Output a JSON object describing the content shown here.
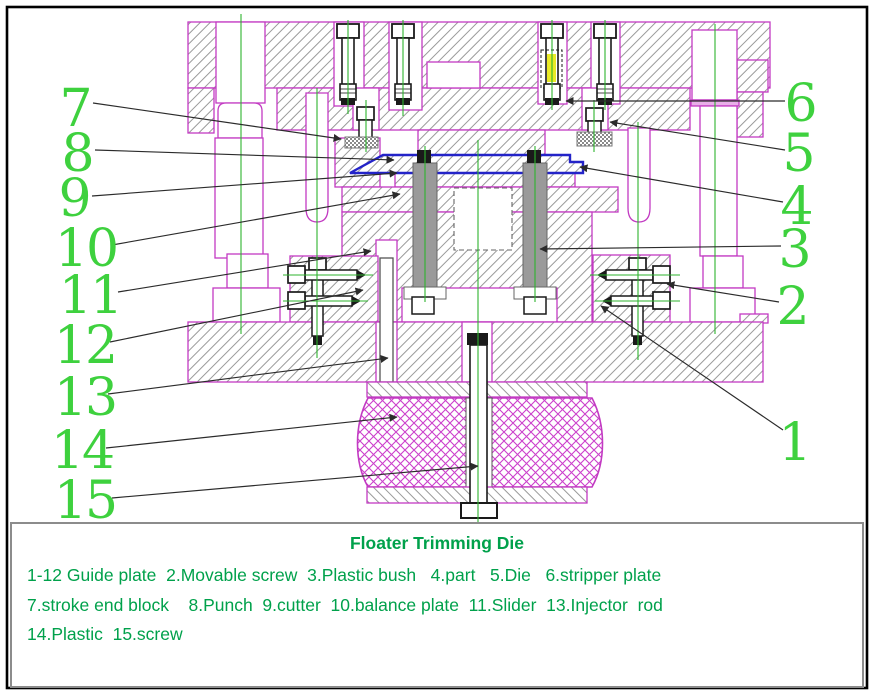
{
  "diagram": {
    "title": "Floater Trimming Die",
    "legend_lines": [
      "1-12 Guide plate  2.Movable screw  3.Plastic bush   4.part   5.Die   6.stripper plate",
      "7.stroke end block    8.Punch  9.cutter  10.balance plate  11.Slider  13.Injector  rod",
      "14.Plastic  15.screw"
    ],
    "parts": [
      {
        "no": "1-12",
        "name": "Guide plate"
      },
      {
        "no": "2",
        "name": "Movable screw"
      },
      {
        "no": "3",
        "name": "Plastic bush"
      },
      {
        "no": "4",
        "name": "part"
      },
      {
        "no": "5",
        "name": "Die"
      },
      {
        "no": "6",
        "name": "stripper plate"
      },
      {
        "no": "7",
        "name": "stroke end block"
      },
      {
        "no": "8",
        "name": "Punch"
      },
      {
        "no": "9",
        "name": "cutter"
      },
      {
        "no": "10",
        "name": "balance plate"
      },
      {
        "no": "11",
        "name": "Slider"
      },
      {
        "no": "13",
        "name": "Injector rod"
      },
      {
        "no": "14",
        "name": "Plastic"
      },
      {
        "no": "15",
        "name": "screw"
      }
    ],
    "callouts": [
      {
        "n": "7",
        "part": "stroke end block",
        "tx": 75,
        "ty": 126,
        "leader": {
          "x1": 93,
          "y1": 103,
          "x2": 341,
          "y2": 139
        }
      },
      {
        "n": "8",
        "part": "Punch",
        "tx": 77,
        "ty": 171,
        "leader": {
          "x1": 95,
          "y1": 150,
          "x2": 394,
          "y2": 160
        }
      },
      {
        "n": "9",
        "part": "cutter",
        "tx": 74,
        "ty": 216,
        "leader": {
          "x1": 92,
          "y1": 196,
          "x2": 397,
          "y2": 173
        }
      },
      {
        "n": "10",
        "part": "balance plate",
        "tx": 86,
        "ty": 266,
        "leader": {
          "x1": 112,
          "y1": 245,
          "x2": 400,
          "y2": 194
        }
      },
      {
        "n": "11",
        "part": "Slider",
        "tx": 90,
        "ty": 313,
        "leader": {
          "x1": 118,
          "y1": 292,
          "x2": 371,
          "y2": 251
        }
      },
      {
        "n": "12",
        "part": "Guide plate",
        "tx": 85,
        "ty": 363,
        "leader": {
          "x1": 110,
          "y1": 342,
          "x2": 363,
          "y2": 290
        }
      },
      {
        "n": "13",
        "part": "Injector rod",
        "tx": 85,
        "ty": 415,
        "leader": {
          "x1": 108,
          "y1": 394,
          "x2": 388,
          "y2": 358
        }
      },
      {
        "n": "14",
        "part": "Plastic",
        "tx": 82,
        "ty": 468,
        "leader": {
          "x1": 106,
          "y1": 448,
          "x2": 397,
          "y2": 417
        }
      },
      {
        "n": "15",
        "part": "screw",
        "tx": 85,
        "ty": 518,
        "leader": {
          "x1": 112,
          "y1": 498,
          "x2": 478,
          "y2": 466
        }
      },
      {
        "n": "6",
        "part": "stripper plate",
        "tx": 800,
        "ty": 121,
        "leader": {
          "x1": 785,
          "y1": 101,
          "x2": 566,
          "y2": 101
        }
      },
      {
        "n": "5",
        "part": "Die",
        "tx": 798,
        "ty": 171,
        "leader": {
          "x1": 785,
          "y1": 150,
          "x2": 610,
          "y2": 122
        }
      },
      {
        "n": "4",
        "part": "part",
        "tx": 796,
        "ty": 224,
        "leader": {
          "x1": 783,
          "y1": 202,
          "x2": 580,
          "y2": 167
        }
      },
      {
        "n": "3",
        "part": "Plastic bush",
        "tx": 794,
        "ty": 267,
        "leader": {
          "x1": 781,
          "y1": 246,
          "x2": 540,
          "y2": 249
        }
      },
      {
        "n": "2",
        "part": "Movable screw",
        "tx": 792,
        "ty": 324,
        "leader": {
          "x1": 779,
          "y1": 302,
          "x2": 667,
          "y2": 284
        }
      },
      {
        "n": "1",
        "part": "Guide plate",
        "tx": 794,
        "ty": 460,
        "leader": {
          "x1": 783,
          "y1": 430,
          "x2": 601,
          "y2": 306
        }
      }
    ],
    "colors": {
      "outline": "#c23ac2",
      "hatch": "#8f8f8f",
      "centerline": "#2eb32e",
      "callout_green": "#3ed13e",
      "text_green": "#00a14b",
      "part_blue": "#2323c8",
      "bolt_dark": "#1a1a1a",
      "highlight_yellow": "#e6e600",
      "leader": "#2b2b2b",
      "plastic_magenta": "#cc3fcc"
    }
  }
}
